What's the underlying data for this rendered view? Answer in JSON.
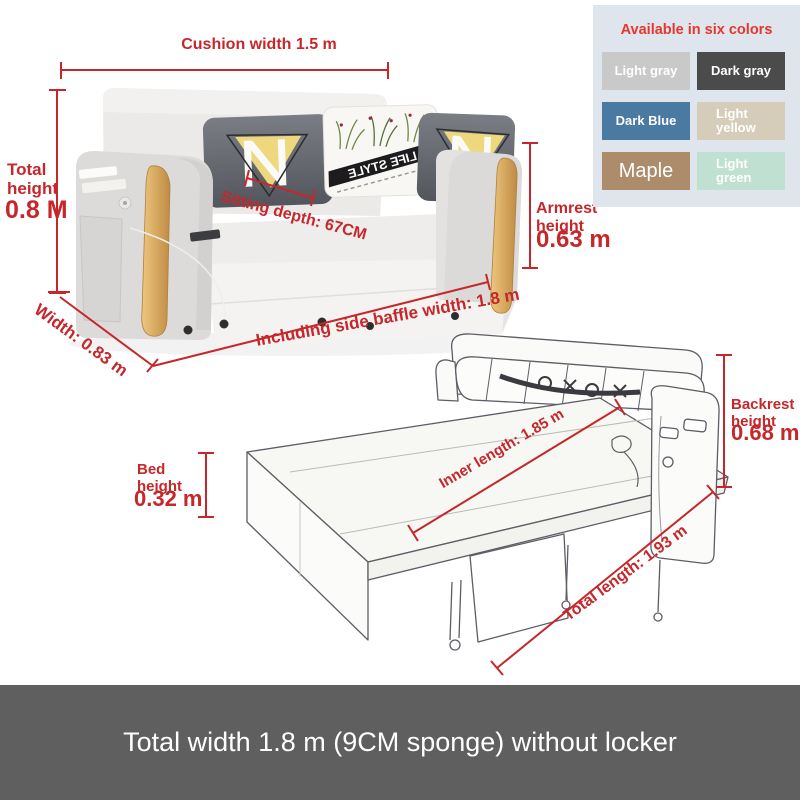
{
  "colors_panel": {
    "title": "Available in six colors",
    "title_color": "#e5372e",
    "panel_bg": "#dfe5ec",
    "swatches": [
      {
        "label": "Light gray",
        "color": "#c9c9c9"
      },
      {
        "label": "Dark gray",
        "color": "#4b4b4b"
      },
      {
        "label": "Dark Blue",
        "color": "#4a7aa2"
      },
      {
        "label": "Light yellow",
        "color": "#d5ccb9"
      },
      {
        "label": "Maple",
        "color": "#ac8c6b"
      },
      {
        "label": "Light green",
        "color": "#c0e0d2"
      }
    ]
  },
  "sofa": {
    "cushion_width": "Cushion width 1.5 m",
    "total_height_label": "Total height",
    "total_height_value": "0.8 M",
    "sitting_depth": "Sitting depth: 67CM",
    "armrest_height_label": "Armrest height",
    "armrest_height_value": "0.63 m",
    "width_label": "Width: 0.83 m",
    "baffle_width_label": "Including side baffle width: 1.8 m",
    "pillow_brand": "LIFE STYLE"
  },
  "bed": {
    "backrest_height_label": "Backrest height",
    "backrest_height_value": "0.68 m",
    "bed_height_label": "Bed height",
    "bed_height_value": "0.32 m",
    "inner_length": "Inner length: 1.85 m",
    "total_length": "Total length: 1.93 m"
  },
  "footer": {
    "text": "Total width 1.8 m (9CM sponge) without locker",
    "bg": "#5f5f5f",
    "text_color": "#ffffff"
  },
  "dimension_color": "#c5272b"
}
